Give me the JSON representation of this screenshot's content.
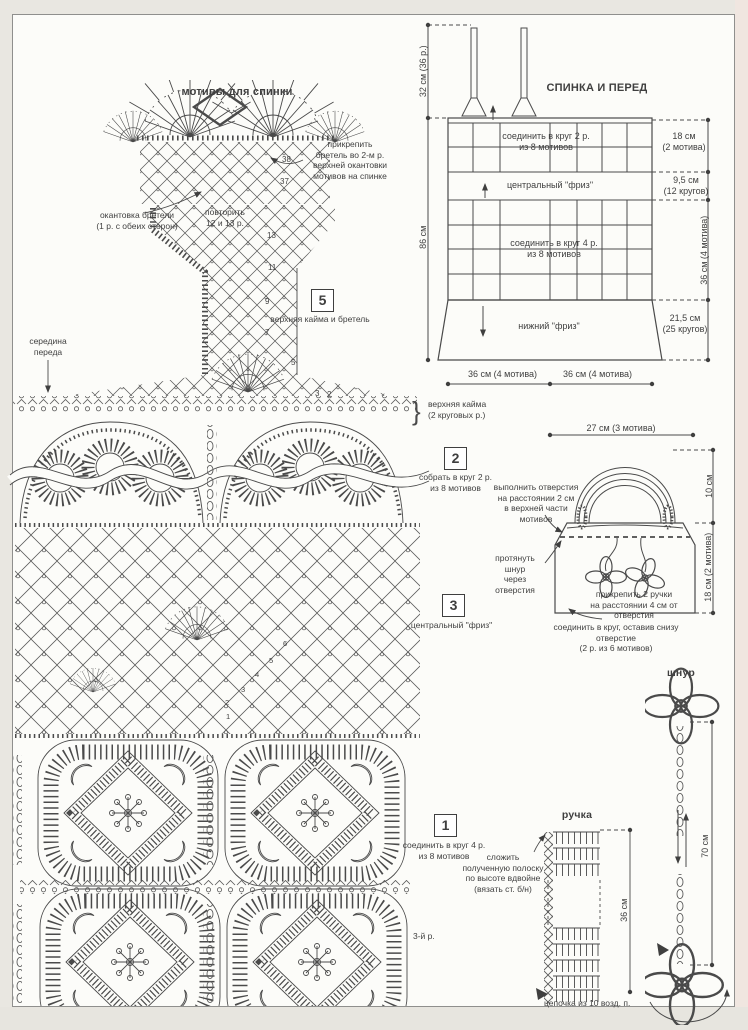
{
  "colors": {
    "paper": "#fcfcf9",
    "ink": "#3f3f3f",
    "margin": "#e9e7e1",
    "edge_pink": "#f0e6e0"
  },
  "left_chart": {
    "title": "мотивы для спинки",
    "attach_strap_note": "прикрепить\nбретель во 2-м р.\nверхней окантовки\nмотивов на спинке",
    "strap_edging_note": "окантовка бретели\n(1 р. с обеих сторон)",
    "repeat_note": "повторить\n12 и 13 р.",
    "center_front": "середина\nпереда",
    "upper_border_note": "верхняя кайма\n(2 круговых р.)",
    "brace": "}",
    "edge_numbers": [
      "38",
      "37"
    ],
    "strap_row_numbers": [
      "13",
      "11",
      "9",
      "7",
      "5",
      "3",
      "2"
    ],
    "mesh_row_numbers": [
      "6",
      "5",
      "4",
      "3",
      "2",
      "1"
    ],
    "row3_note": "3-й р."
  },
  "steps": [
    {
      "num": "5",
      "label": "верхняя кайма и бретель"
    },
    {
      "num": "2",
      "label": "собрать в круг 2 р.\nиз 8 мотивов"
    },
    {
      "num": "3",
      "label": "центральный \"фриз\""
    },
    {
      "num": "1",
      "label": "соединить в круг 4 р.\nиз 8 мотивов"
    }
  ],
  "schematic": {
    "title": "СПИНКА И ПЕРЕД",
    "zone_top": "соединить в круг 2 р.\nиз 8 мотивов",
    "zone_frieze": "центральный \"фриз\"",
    "zone_main": "соединить в круг 4 р.\nиз 8 мотивов",
    "zone_bottom": "нижний \"фриз\"",
    "dim_strap": "32 см (36 р.)",
    "dim_height": "86 см",
    "dim_top_band": "18 см\n(2 мотива)",
    "dim_frieze": "9,5 см\n(12 кругов)",
    "dim_main_band": "36 см (4 мотива)",
    "dim_bottom_band": "21,5 см\n(25 кругов)",
    "dim_width_left": "36 см (4 мотива)",
    "dim_width_right": "36 см (4 мотива)"
  },
  "bag": {
    "dim_top": "27 см (3 мотива)",
    "dim_handle": "10 см",
    "dim_body": "18 см (2 мотива)",
    "holes_note": "выполнить отверстия\nна расстоянии 2 см\nв верхней части мотивов",
    "cord_note": "протянуть шнур\nчерез отверстия",
    "handles_note": "прикрепить 2 ручки\nна расстоянии 4 см от отверстия",
    "join_note": "соединить в круг, оставив снизу отверстие\n(2 р. из 6 мотивов)"
  },
  "cord": {
    "title": "шнур",
    "dim": "70 см"
  },
  "handle": {
    "title": "ручка",
    "dim": "36 см",
    "fold_note": "сложить\nполученную полоску\nпо высоте вдвойне\n(вязать ст. б/н)",
    "chain_note": "цепочка из 10 возд. п."
  }
}
